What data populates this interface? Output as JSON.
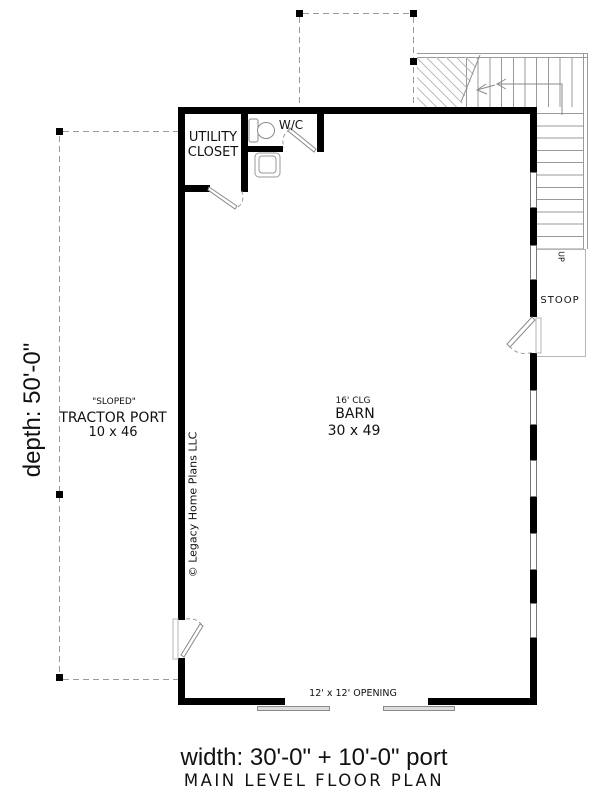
{
  "plan": {
    "rooms": {
      "utility_closet": {
        "line1": "UTILITY",
        "line2": "CLOSET"
      },
      "wc": {
        "label": "W/C"
      },
      "barn": {
        "ceiling": "16' CLG",
        "name": "BARN",
        "size": "30 x 49"
      },
      "tractor_port": {
        "note": "\"SLOPED\"",
        "name": "TRACTOR PORT",
        "size": "10 x 46"
      },
      "stoop": {
        "label": "STOOP"
      },
      "stairs": {
        "direction": "UP"
      }
    },
    "annotations": {
      "opening": "12' x 12' OPENING",
      "depth": "depth: 50'-0\"",
      "width": "width: 30'-0\" + 10'-0\" port",
      "title": "MAIN LEVEL FLOOR PLAN",
      "copyright": "© Legacy Home Plans LLC"
    },
    "colors": {
      "wall": "#000000",
      "thin_line": "#9a9a9a",
      "dashed_line": "#9a9a9a",
      "hatch": "#bdbdbd",
      "background": "#ffffff"
    }
  }
}
